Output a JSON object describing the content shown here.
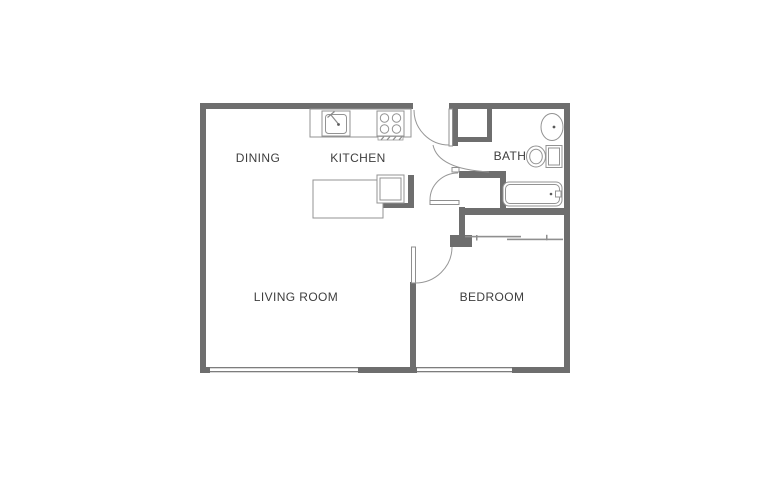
{
  "diagram": {
    "type": "floor-plan",
    "title": "One-bedroom apartment floor plan",
    "background": "#ffffff",
    "wall_color": "#6e6e6e",
    "line_color": "#8f8f8f",
    "window_color": "#7d7d7d",
    "label_color": "#3e3e3e",
    "rooms": {
      "dining": "DINING",
      "kitchen": "KITCHEN",
      "bath": "BATH",
      "living_room": "LIVING ROOM",
      "bedroom": "BEDROOM"
    },
    "fixtures": [
      "entry-door",
      "entry-closet",
      "kitchen-sink",
      "stove",
      "kitchen-island",
      "kitchen-appliance",
      "bath-door",
      "hall-door",
      "bath-pedestal-sink",
      "toilet",
      "bathtub",
      "bedroom-door",
      "bedroom-sliding-closet",
      "living-room-window",
      "bedroom-window"
    ]
  }
}
